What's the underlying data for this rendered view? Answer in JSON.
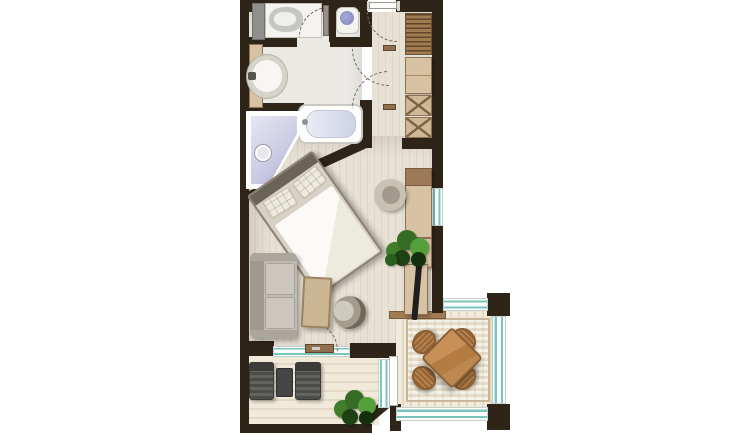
{
  "meta": {
    "image_type": "apartment floor plan, rendered top-down view",
    "orientation": "entry at top, two balconies at bottom"
  },
  "colors": {
    "wall": "#2f2418",
    "glass": "#79c4bc",
    "floor_a": "#e8e2d6",
    "floor_b": "#ded5c6",
    "bath_floor": "#ebe9e4",
    "deck_a": "#f1eadb",
    "deck_b": "#e3d9c5",
    "wood_cabinet": "#d7c3a4",
    "wood_border": "#8d7356",
    "wardrobe_wood": "#a07c50",
    "table_wood": "#bd8751",
    "chair_wood": "#b5824d",
    "sofa_gray": "#bfbbb2",
    "lounge_gray": "#545452",
    "plant_green": "#4e8c36",
    "bed_frame": "#8b8275",
    "shower_lavender": "#c9c9e2",
    "threshold_brown": "#a07c54",
    "radiator_teal": "#6fbfb8",
    "tv_black": "#1f1f1f",
    "arc_gray": "#6f695e"
  },
  "plan": {
    "rooms": [
      {
        "id": "bathroom",
        "label": "Bathroom",
        "fixtures": [
          "washing machine",
          "laundry counter",
          "toilet",
          "round vessel basin on vanity",
          "towel radiator",
          "bathtub",
          "corner shower"
        ]
      },
      {
        "id": "hallway",
        "label": "Entry hall",
        "fixtures": [
          "entry door with swing arc",
          "two interior doors with crossing swing arcs",
          "wardrobe hanging rail",
          "shelf cabinet",
          "two lattice-front cabinets",
          "built-in block"
        ]
      },
      {
        "id": "living-bedroom",
        "label": "Living / bedroom",
        "fixtures": [
          "double bed placed diagonally",
          "desk",
          "swivel tub chair",
          "TV cabinet with TV",
          "potted plant",
          "sofa",
          "work table",
          "round lounge chair",
          "balcony door with swing arc",
          "window in right wall"
        ]
      },
      {
        "id": "terrace",
        "label": "Left terrace",
        "fixtures": [
          "sun lounger",
          "side table",
          "sun lounger",
          "potted plant",
          "chamfered corner wall",
          "glazed wall"
        ]
      },
      {
        "id": "glazed-balcony",
        "label": "Right glazed balcony",
        "fixtures": [
          "rug",
          "square wooden dining table rotated 45 degrees",
          "four rattan dining chairs",
          "glazing on three sides",
          "threshold step"
        ]
      }
    ]
  }
}
